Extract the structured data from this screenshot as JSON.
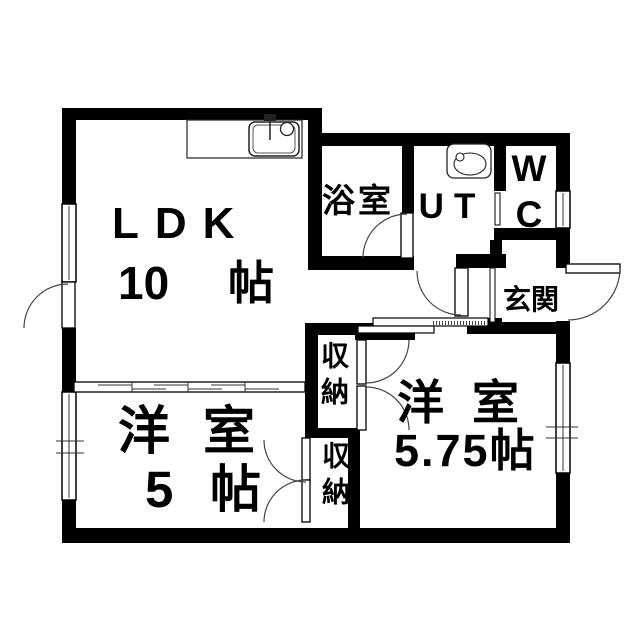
{
  "plan": {
    "type": "apartment-floor-plan",
    "colors": {
      "wall": "#000000",
      "background": "#ffffff",
      "text": "#000000",
      "line": "#333333"
    },
    "rooms": {
      "ldk": {
        "label": "LDK",
        "area_value": "10",
        "area_unit": "帖"
      },
      "bathroom": {
        "label": "浴室"
      },
      "utility": {
        "label": "UT"
      },
      "toilet": {
        "label_top": "W",
        "label_bottom": "C"
      },
      "entrance": {
        "label": "玄関"
      },
      "bedroom_left": {
        "label": "洋室",
        "area_value": "5",
        "area_unit": "帖"
      },
      "bedroom_right": {
        "label": "洋室",
        "area": "5.75帖"
      },
      "closet_upper": {
        "label": "収納"
      },
      "closet_lower": {
        "label": "収納"
      }
    },
    "fixtures": {
      "kitchen_sink": "kitchen-sink-icon",
      "washbasin": "washbasin-icon"
    }
  }
}
